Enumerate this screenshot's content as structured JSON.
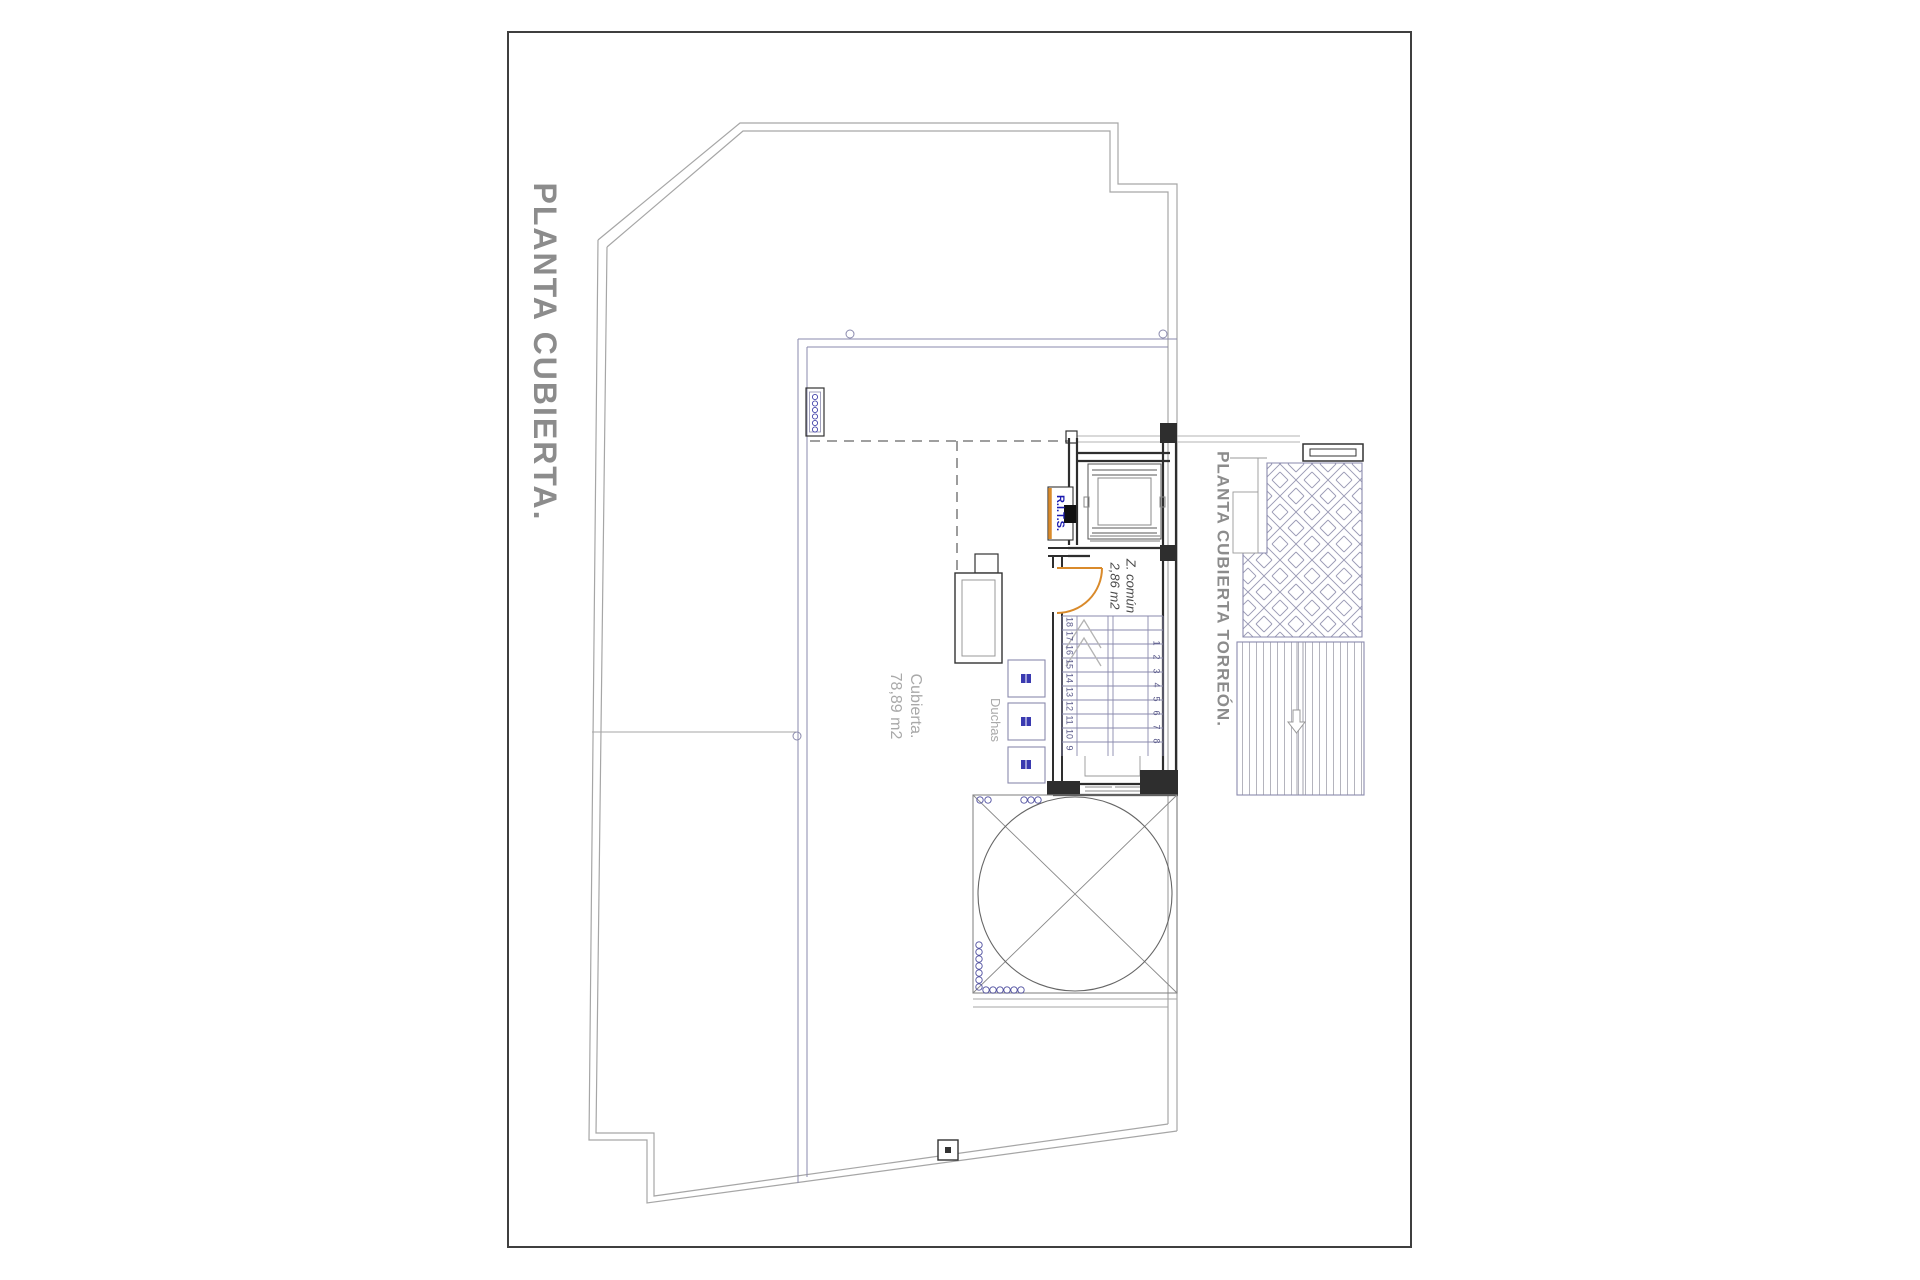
{
  "titles": {
    "main": "PLANTA CUBIERTA.",
    "torreon": "PLANTA CUBIERTA TORREÓN."
  },
  "areas": {
    "cubierta": {
      "name": "Cubierta.",
      "size": "78,89 m2"
    },
    "z_comun": {
      "name": "Z. común",
      "size": "2,86 m2"
    },
    "duchas": "Duchas",
    "rits": "R.I.T.S."
  },
  "stairs": {
    "left_numbers": [
      "18",
      "17",
      "16",
      "15",
      "14",
      "13",
      "12",
      "11",
      "10",
      "9"
    ],
    "right_numbers": [
      "1",
      "2",
      "3",
      "4",
      "5",
      "6",
      "7",
      "8"
    ]
  },
  "colors": {
    "sheet_border": "#3f3f3f",
    "outline_gray": "#a6a6a6",
    "plan_blue": "#8a8aad",
    "wall_dark": "#2e2e2e",
    "accent_orange": "#d98a2b",
    "title_gray": "#8c8c8c",
    "label_gray": "#a9a9a9",
    "rits_blue": "#1b1bb0"
  }
}
